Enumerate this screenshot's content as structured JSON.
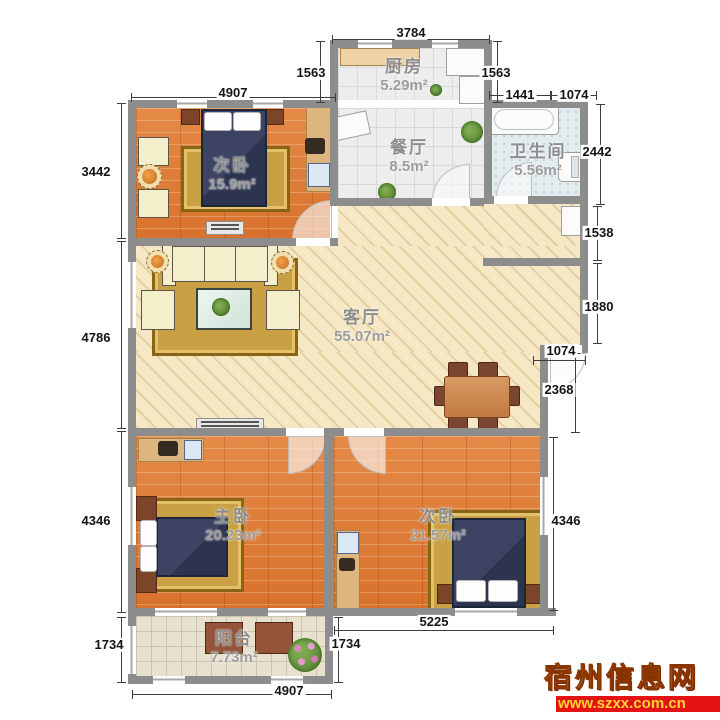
{
  "rooms": [
    {
      "id": "kitchen",
      "name": "厨房",
      "area": "5.29m²",
      "x": 404,
      "y": 52
    },
    {
      "id": "dining",
      "name": "餐厅",
      "area": "8.5m²",
      "x": 409,
      "y": 133
    },
    {
      "id": "bathroom",
      "name": "卫生间",
      "area": "5.56m²",
      "x": 538,
      "y": 137
    },
    {
      "id": "bedroom-a",
      "name": "次卧",
      "area": "15.9m²",
      "x": 232,
      "y": 151
    },
    {
      "id": "living",
      "name": "客厅",
      "area": "55.07m²",
      "x": 362,
      "y": 303
    },
    {
      "id": "master",
      "name": "主卧",
      "area": "20.23m²",
      "x": 233,
      "y": 502
    },
    {
      "id": "bedroom-b",
      "name": "次卧",
      "area": "21.57m²",
      "x": 438,
      "y": 502
    },
    {
      "id": "balcony",
      "name": "阳台",
      "area": "7.73m²",
      "x": 234,
      "y": 624
    }
  ],
  "dims": [
    {
      "t": "3784",
      "o": "h",
      "a": 332,
      "b": 490,
      "p": 39,
      "lx": 411,
      "ly": 33
    },
    {
      "t": "4907",
      "o": "h",
      "a": 131,
      "b": 336,
      "p": 97,
      "lx": 233,
      "ly": 93
    },
    {
      "t": "1441",
      "o": "h",
      "a": 489,
      "b": 551,
      "p": 95,
      "lx": 520,
      "ly": 95
    },
    {
      "t": "1074",
      "o": "h",
      "a": 551,
      "b": 597,
      "p": 95,
      "lx": 574,
      "ly": 95
    },
    {
      "t": "1563",
      "o": "v",
      "a": 41,
      "b": 103,
      "p": 320,
      "lx": 311,
      "ly": 73
    },
    {
      "t": "1563",
      "o": "v",
      "a": 41,
      "b": 103,
      "p": 497,
      "lx": 496,
      "ly": 73
    },
    {
      "t": "2442",
      "o": "v",
      "a": 104,
      "b": 205,
      "p": 600,
      "lx": 597,
      "ly": 152
    },
    {
      "t": "3442",
      "o": "v",
      "a": 103,
      "b": 239,
      "p": 121,
      "lx": 96,
      "ly": 172
    },
    {
      "t": "4786",
      "o": "v",
      "a": 241,
      "b": 429,
      "p": 121,
      "lx": 96,
      "ly": 338
    },
    {
      "t": "4346",
      "o": "v",
      "a": 431,
      "b": 613,
      "p": 121,
      "lx": 96,
      "ly": 521
    },
    {
      "t": "1734",
      "o": "v",
      "a": 617,
      "b": 683,
      "p": 121,
      "lx": 109,
      "ly": 645
    },
    {
      "t": "1538",
      "o": "v",
      "a": 206,
      "b": 261,
      "p": 597,
      "lx": 599,
      "ly": 233
    },
    {
      "t": "1880",
      "o": "v",
      "a": 263,
      "b": 344,
      "p": 597,
      "lx": 599,
      "ly": 307
    },
    {
      "t": "1074",
      "o": "h",
      "a": 533,
      "b": 586,
      "p": 360,
      "lx": 561,
      "ly": 351
    },
    {
      "t": "2368",
      "o": "v",
      "a": 353,
      "b": 433,
      "p": 575,
      "lx": 559,
      "ly": 390
    },
    {
      "t": "4346",
      "o": "v",
      "a": 437,
      "b": 611,
      "p": 553,
      "lx": 566,
      "ly": 521
    },
    {
      "t": "5225",
      "o": "h",
      "a": 334,
      "b": 554,
      "p": 630,
      "lx": 434,
      "ly": 622
    },
    {
      "t": "4907",
      "o": "h",
      "a": 132,
      "b": 332,
      "p": 694,
      "lx": 289,
      "ly": 691
    },
    {
      "t": "1734",
      "o": "v",
      "a": 617,
      "b": 683,
      "p": 338,
      "lx": 346,
      "ly": 644
    }
  ],
  "watermark": {
    "site_name": "宿州信息网",
    "site_url": "www.szxx.com.cn"
  },
  "colors": {
    "wall": "#8d8d8d",
    "wood": "#df8140",
    "beige": "#f6e8c4",
    "navy": "#2d3450",
    "gold": "#c9a144",
    "wm_red": "#e31313",
    "wm_yellow": "#ffc83d"
  }
}
